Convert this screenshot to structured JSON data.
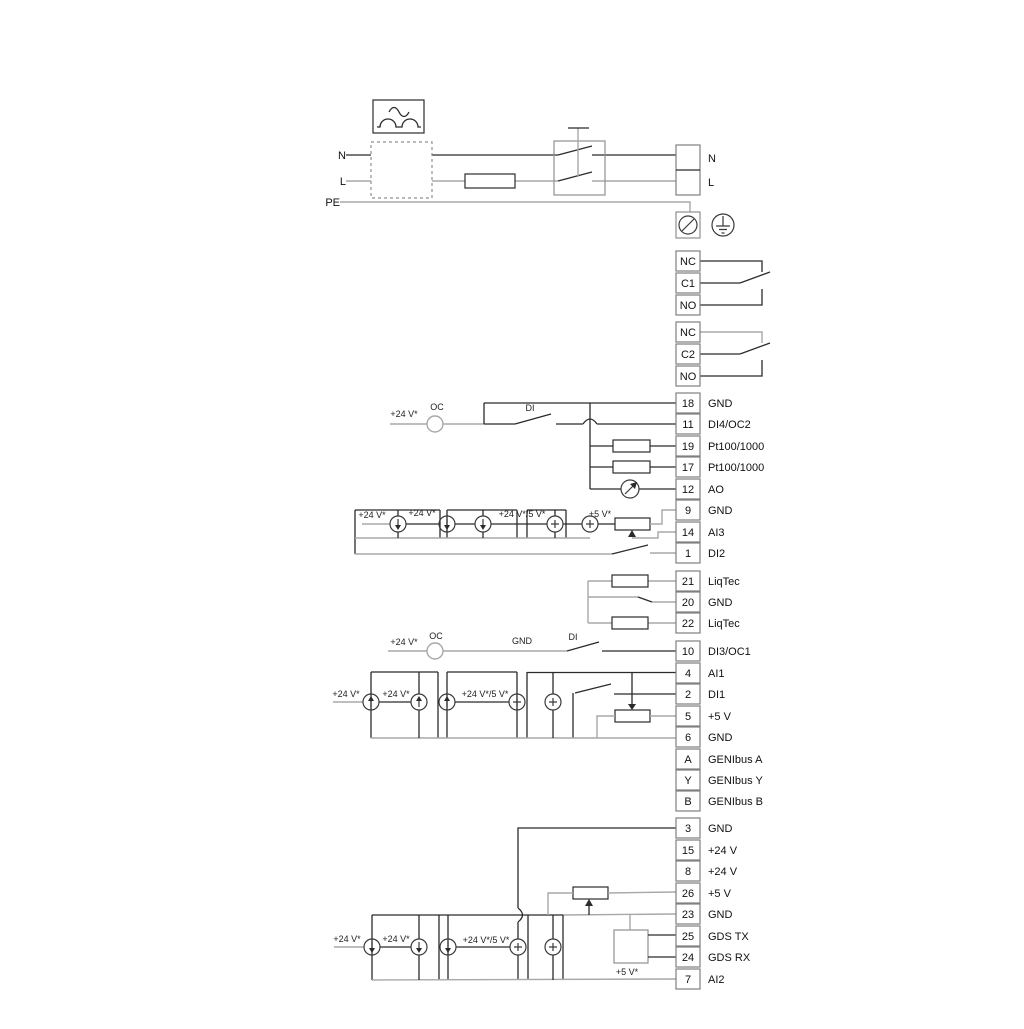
{
  "colors": {
    "background": "#ffffff",
    "wire_dark": "#2b2b2b",
    "wire_gray": "#a8a8a8",
    "cell_border": "#7f7f7f",
    "text": "#111111"
  },
  "power": {
    "labels": {
      "n": "N",
      "l": "L",
      "pe": "PE"
    },
    "terminal": {
      "n": "N",
      "l": "L"
    }
  },
  "relay1": {
    "nc": "NC",
    "c": "C1",
    "no": "NO"
  },
  "relay2": {
    "nc": "NC",
    "c": "C2",
    "no": "NO"
  },
  "io1": {
    "rows": [
      {
        "id": "18",
        "label": "GND"
      },
      {
        "id": "11",
        "label": "DI4/OC2"
      },
      {
        "id": "19",
        "label": "Pt100/1000"
      },
      {
        "id": "17",
        "label": "Pt100/1000"
      },
      {
        "id": "12",
        "label": "AO"
      },
      {
        "id": "9",
        "label": "GND"
      },
      {
        "id": "14",
        "label": "AI3"
      },
      {
        "id": "1",
        "label": "DI2"
      }
    ]
  },
  "liqtec": {
    "rows": [
      {
        "id": "21",
        "label": "LiqTec"
      },
      {
        "id": "20",
        "label": "GND"
      },
      {
        "id": "22",
        "label": "LiqTec"
      }
    ]
  },
  "di3": {
    "id": "10",
    "label": "DI3/OC1"
  },
  "io2": {
    "rows": [
      {
        "id": "4",
        "label": "AI1"
      },
      {
        "id": "2",
        "label": "DI1"
      },
      {
        "id": "5",
        "label": "+5 V"
      },
      {
        "id": "6",
        "label": "GND"
      },
      {
        "id": "A",
        "label": "GENIbus A"
      },
      {
        "id": "Y",
        "label": "GENIbus Y"
      },
      {
        "id": "B",
        "label": "GENIbus B"
      }
    ]
  },
  "io3": {
    "rows": [
      {
        "id": "3",
        "label": "GND"
      },
      {
        "id": "15",
        "label": "+24 V"
      },
      {
        "id": "8",
        "label": "+24 V"
      },
      {
        "id": "26",
        "label": "+5 V"
      },
      {
        "id": "23",
        "label": "GND"
      },
      {
        "id": "25",
        "label": "GDS TX"
      },
      {
        "id": "24",
        "label": "GDS RX"
      },
      {
        "id": "7",
        "label": "AI2"
      }
    ]
  },
  "annotations": {
    "v24": "+24 V*",
    "v24_5": "+24 V*/5 V*",
    "v5": "+5 V*",
    "oc": "OC",
    "di": "DI",
    "gnd": "GND"
  }
}
